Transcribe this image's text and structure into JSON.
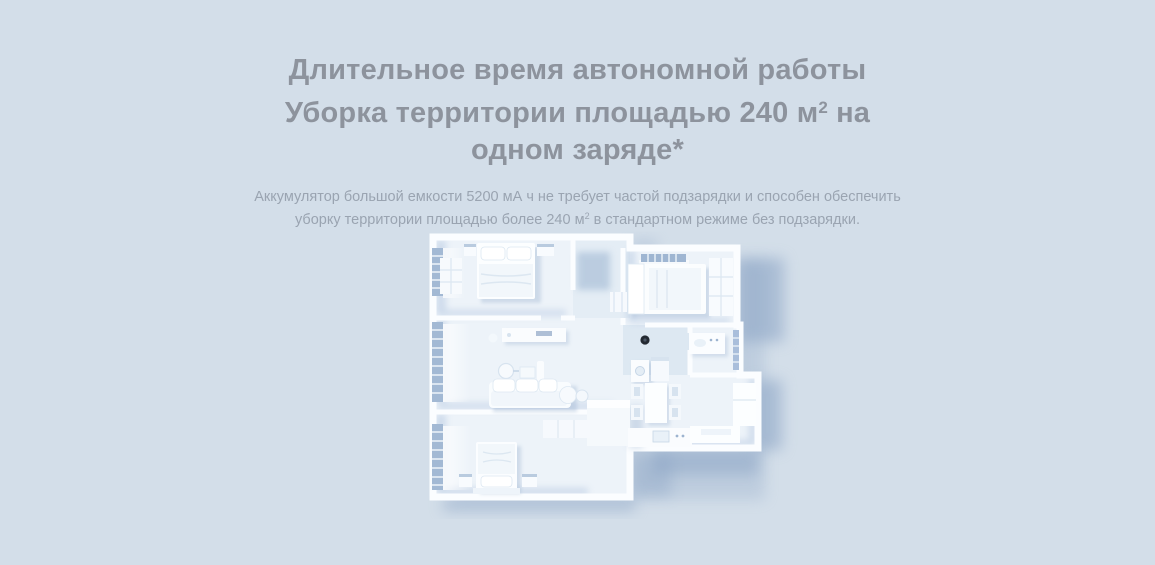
{
  "page": {
    "background_color": "#d3dee9",
    "accent_shadow_color": "#89a3c4",
    "wall_color": "#fbfdff",
    "floor_color": "#edf3f9",
    "robot_dot_color": "#232932",
    "title_color": "#8d939d",
    "description_color": "#9aa4b1"
  },
  "hero": {
    "title": {
      "line1": "Длительное время автономной работы",
      "line2_before": "Уборка территории площадью 240 м",
      "line2_sup": "2",
      "line2_after": " на",
      "line3": "одном заряде*"
    },
    "description": {
      "line1": "Аккумулятор большой емкости 5200 мА ч не требует частой подзарядки и способен обеспечить",
      "line2_before": "уборку территории площадью более 240 м",
      "line2_sup": "2",
      "line2_after": " в стандартном режиме без подзарядки."
    }
  },
  "illustration": {
    "label": "3D-план квартиры 240 м² с роботом-пылесосом"
  }
}
